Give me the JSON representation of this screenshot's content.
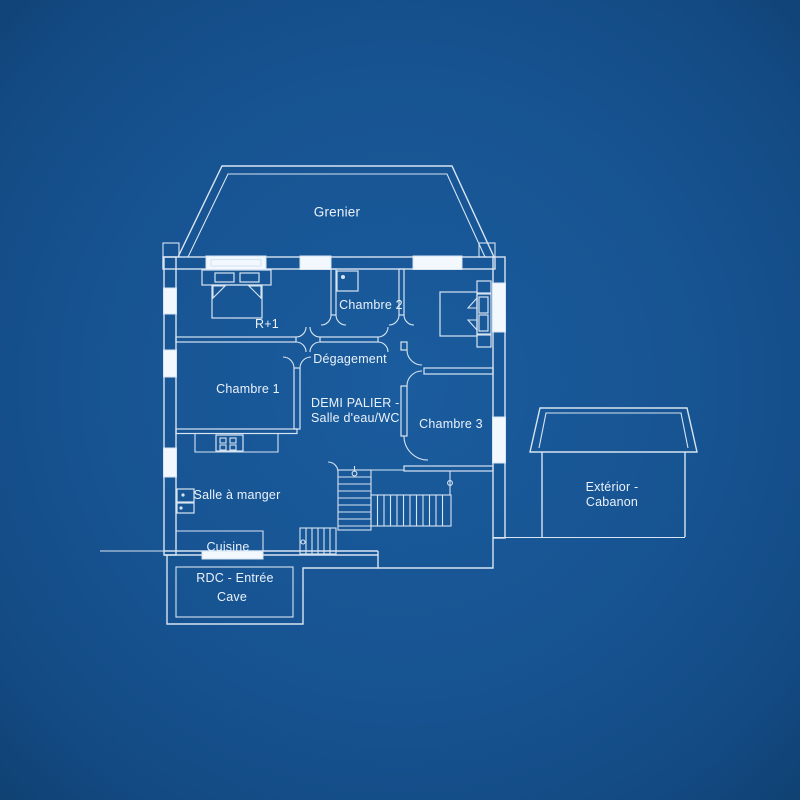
{
  "title": "Plan de maison — blueprint",
  "colors": {
    "background": "#175391",
    "background_edge": "#0f3f6e",
    "line": "#d7e4f2",
    "window_fill": "#f2f8fd",
    "text": "#eaf2fb"
  },
  "rooms": {
    "grenier": {
      "label": "Grenier"
    },
    "r_plus_1": {
      "label": "R+1"
    },
    "chambre_2": {
      "label": "Chambre 2"
    },
    "chambre_1": {
      "label": "Chambre 1"
    },
    "degagement": {
      "label": "Dégagement"
    },
    "demi_palier": {
      "line1": "DEMI PALIER -",
      "line2": "Salle d'eau/WC"
    },
    "chambre_3": {
      "label": "Chambre 3"
    },
    "salle_a_manger": {
      "label": "Salle à manger"
    },
    "cuisine": {
      "label": "Cuisine"
    },
    "rdc_entree": {
      "line1": "RDC - Entrée",
      "line2": "Cave"
    },
    "exterieur_cabanon": {
      "line1": "Extérior -",
      "line2": "Cabanon"
    }
  },
  "icons": [
    "double-bed-icon",
    "single-bed-icon",
    "sink-icon",
    "stove-icon",
    "wc-icon",
    "stair-flight",
    "stair-start-marker",
    "door-splay",
    "door-arc"
  ],
  "structure": {
    "windows_top": 3,
    "windows_left": 3,
    "windows_right": 2,
    "stair_flights": 3,
    "entry_door_bar": 1
  }
}
